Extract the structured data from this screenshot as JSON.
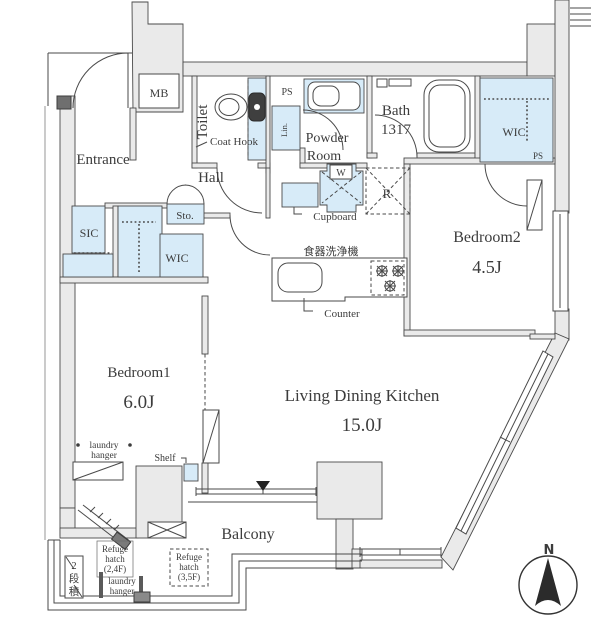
{
  "colors": {
    "wall_fill": "#eaeaea",
    "wall_line": "#4a4a4a",
    "closet_fill": "#d7ebf8",
    "text": "#3c3c3c"
  },
  "rooms": {
    "entrance": {
      "label": "Entrance"
    },
    "hall": {
      "label": "Hall"
    },
    "toilet": {
      "label": "Toilet"
    },
    "powder_room": {
      "lines": [
        "Powder",
        "Room"
      ]
    },
    "bath": {
      "lines": [
        "Bath",
        "1317"
      ]
    },
    "bedroom1": {
      "label": "Bedroom1",
      "size": "6.0J"
    },
    "bedroom2": {
      "label": "Bedroom2",
      "size": "4.5J"
    },
    "ldk": {
      "label": "Living Dining Kitchen",
      "size": "15.0J"
    },
    "balcony": {
      "label": "Balcony"
    }
  },
  "storage": {
    "mb": "MB",
    "ps_top": "PS",
    "lin": "Lin.",
    "sic": "SIC",
    "wic_hall": "WIC",
    "sto": "Sto.",
    "wic_bedroom2": "WIC",
    "ps_bedroom2": "PS",
    "cupboard": "Cupboard"
  },
  "fixtures": {
    "coat_hook": "Coat Hook",
    "washer": "W",
    "fridge": "R",
    "dishwasher": "食器洗浄機",
    "counter": "Counter",
    "shelf": "Shelf",
    "laundry_hanger_bedroom1": [
      "laundry",
      "hanger"
    ],
    "laundry_hanger_balcony": [
      "laundry",
      "hanger"
    ],
    "refuge_hatch_24": [
      "Refuge",
      "hatch",
      "(2,4F)"
    ],
    "refuge_hatch_35": [
      "Refuge",
      "hatch",
      "(3,5F)"
    ],
    "two_tier_stack": [
      "2",
      "段",
      "積"
    ]
  },
  "compass": {
    "north": "N"
  }
}
